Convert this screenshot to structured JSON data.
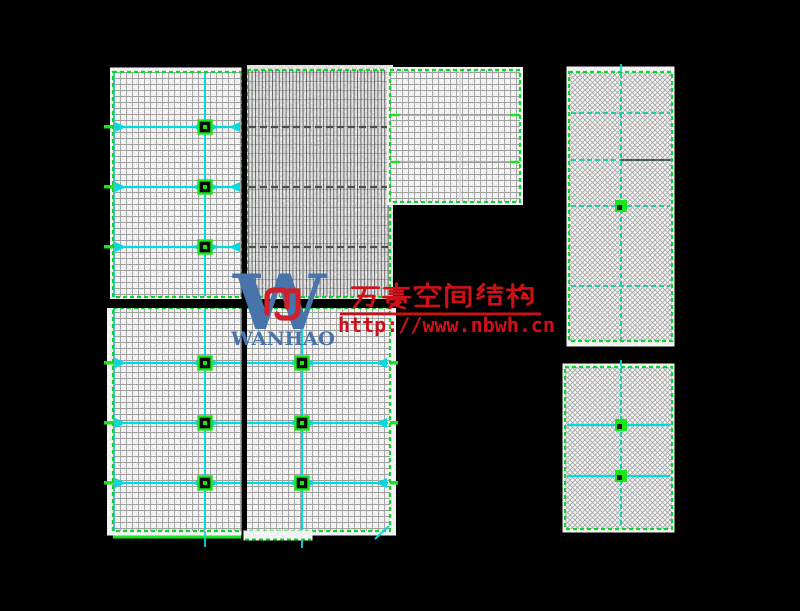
{
  "background": "#000000",
  "colors": {
    "edge_green": "#0fd42c",
    "lime": "#1ae51a",
    "cyan": "#00dcdc",
    "teal": "#00cfa0",
    "panel_base": "#c9c9c9",
    "dark_row": "#4d4d4d",
    "gray_row": "#9d9d9d",
    "light_col": "#d8d8d8",
    "gray_col": "#8f8f8f",
    "watermark_red": "#cf1018",
    "logo_blue": "#4874ac",
    "divider": "#000000"
  },
  "watermark": {
    "company_cn": "万豪空间结构",
    "url": "http://www.nbwh.cn",
    "wordmark": "WANHAO",
    "logo_letter": "W"
  },
  "drawing": {
    "structures": [
      {
        "id": "upper-left",
        "x": 113,
        "y": 72,
        "w": 129,
        "h": 225,
        "texture": "ortho",
        "leftCyan": true,
        "rows": {
          "style": "cyanArrow",
          "ys": [
            127,
            187,
            247
          ],
          "spans": [
            [
              115,
              203
            ],
            [
              208,
              240
            ]
          ]
        },
        "cols": {
          "style": "cyan",
          "xs": [
            205
          ]
        },
        "squares": [
          [
            205,
            127
          ],
          [
            205,
            187
          ],
          [
            205,
            247
          ]
        ],
        "edgeTicks": true
      },
      {
        "id": "upper-middle",
        "x": 247,
        "y": 70,
        "w": 143,
        "h": 227,
        "texture": "dense",
        "rows": {
          "style": "dark",
          "ys": [
            127,
            187,
            247
          ]
        },
        "cols": {
          "style": "gray",
          "xs": [
            303
          ]
        }
      },
      {
        "id": "upper-right",
        "x": 390,
        "y": 70,
        "w": 130,
        "h": 132,
        "texture": "ortho",
        "rows": {
          "style": "grayTick",
          "ys": [
            115,
            162
          ]
        },
        "cols": {
          "style": "light",
          "xs": [
            460
          ]
        }
      },
      {
        "id": "lower-left",
        "x": 113,
        "y": 308,
        "w": 277,
        "h": 223,
        "texture": "ortho",
        "leftCyan": true,
        "rows": {
          "style": "cyanArrow",
          "ys": [
            363,
            423,
            483
          ],
          "spans": [
            [
              115,
              203
            ],
            [
              208,
              300
            ],
            [
              305,
              387
            ]
          ]
        },
        "cols": {
          "style": "cyan",
          "xs": [
            205,
            302
          ]
        },
        "squares": [
          [
            205,
            363
          ],
          [
            205,
            423
          ],
          [
            205,
            483
          ],
          [
            302,
            363
          ],
          [
            302,
            423
          ],
          [
            302,
            483
          ]
        ],
        "edgeTicks": true
      },
      {
        "id": "right-top",
        "x": 569,
        "y": 72,
        "w": 103,
        "h": 269,
        "texture": "diag",
        "rows": {
          "style": "tealDash",
          "ys": [
            113,
            160,
            206,
            286
          ]
        },
        "cols": {
          "style": "tealDash",
          "xs": [
            621
          ]
        },
        "squares": [
          [
            621,
            206
          ]
        ],
        "darkRows": [
          [
            621,
            671,
            160
          ]
        ]
      },
      {
        "id": "right-bottom",
        "x": 565,
        "y": 367,
        "w": 107,
        "h": 162,
        "texture": "diag",
        "rows": {
          "style": "cyanSq",
          "ys": [
            425,
            476
          ]
        },
        "cols": {
          "style": "tealDash",
          "xs": [
            621
          ]
        },
        "squares": [
          [
            621,
            425
          ],
          [
            621,
            476
          ]
        ]
      }
    ],
    "dividers": {
      "vertical": {
        "x": 241.5,
        "y": 64,
        "w": 5.5,
        "h": 482
      },
      "horizontal": {
        "x": 105,
        "y": 299,
        "w": 330,
        "h": 9
      }
    },
    "extras": {
      "solid_green_line": {
        "x1": 113,
        "x2": 241,
        "y": 537
      },
      "bottom_patch": {
        "x": 245,
        "y": 531,
        "w": 66,
        "h": 9
      },
      "cyan_ticks": [
        [
          205,
          531,
          547
        ],
        [
          302,
          540,
          548
        ],
        [
          621,
          64,
          72
        ],
        [
          621,
          360,
          367
        ]
      ],
      "diag_tick": [
        375,
        539,
        389,
        526
      ]
    }
  }
}
